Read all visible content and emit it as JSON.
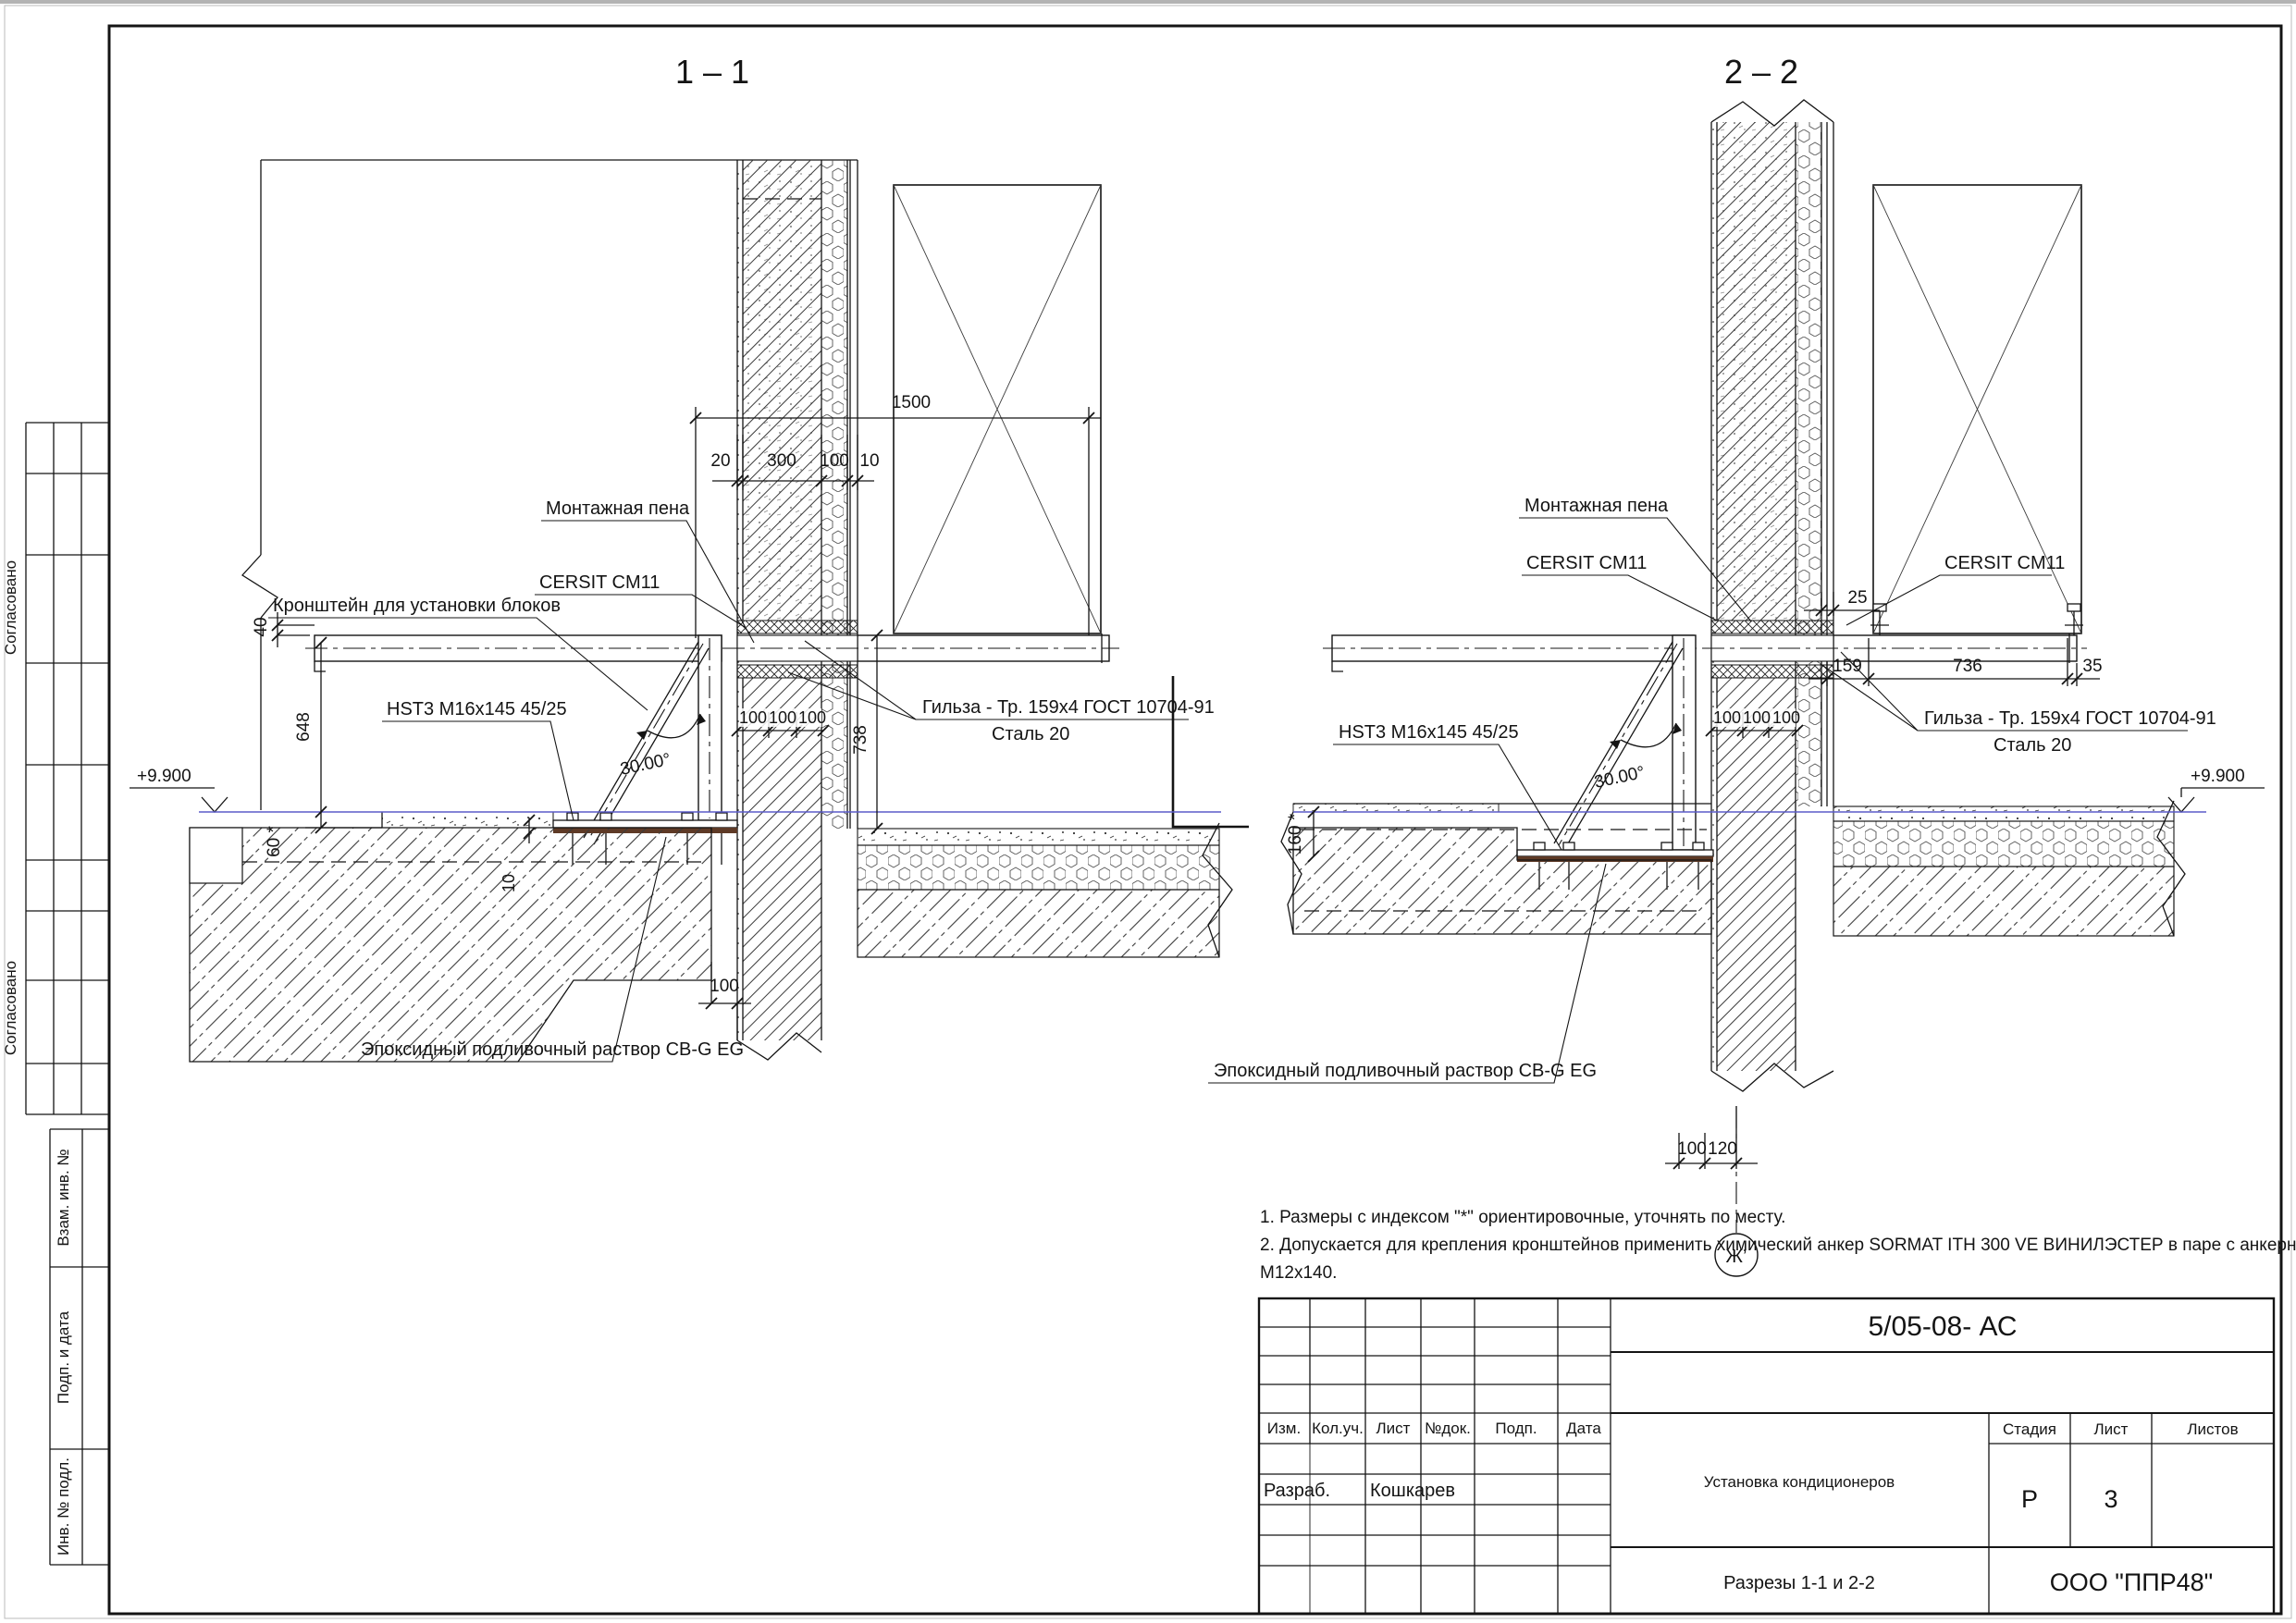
{
  "s11": {
    "title": "1 – 1",
    "montage_foam": "Монтажная пена",
    "cersit": "CERSIT CM11",
    "bracket": "Кронштейн для установки блоков",
    "hst": "HST3 M16x145 45/25",
    "gilza1": "Гильза - Тр. 159x4 ГОСТ 10704-91",
    "gilza2": "Сталь 20",
    "epoxy": "Эпоксидный подливочный раствор CB-G EG",
    "angle": "30.00°",
    "level": "+9.900",
    "d1500": "1500",
    "d20": "20",
    "d300": "300",
    "d100wall": "100",
    "d10": "10",
    "d40": "40",
    "d648": "648",
    "d60": "60 *",
    "d100_1": "100",
    "d100_2": "100",
    "d100_3": "100",
    "d738": "738",
    "d100gap": "100",
    "d10plate": "10"
  },
  "s22": {
    "title": "2 – 2",
    "montage_foam": "Монтажная пена",
    "cersit_left": "CERSIT CM11",
    "cersit_right": "CERSIT CM11",
    "hst": "HST3 M16x145 45/25",
    "gilza1": "Гильза - Тр. 159x4 ГОСТ 10704-91",
    "gilza2": "Сталь 20",
    "epoxy": "Эпоксидный подливочный раствор CB-G EG",
    "angle": "30.00°",
    "level": "+9.900",
    "d25": "25",
    "d159": "159",
    "d736": "736",
    "d35": "35",
    "d100_1": "100",
    "d100_2": "100",
    "d100_3": "100",
    "d160": "160 *",
    "d100b": "100",
    "d120": "120",
    "axis": "Ж’"
  },
  "notes": [
    "1. Размеры с индексом \"*\" ориентировочные, уточнять по месту.",
    "2. Допускается для крепления кронштейнов применить химический анкер SORMAT ITH 300 VE ВИНИЛЭСТЕР в паре с анкерной шпилькой Hilti Hit Z",
    "М12х140."
  ],
  "sidebar": {
    "soglasovano1": "Согласовано",
    "soglasovano2": "Согласовано",
    "vzam": "Взам. инв. №",
    "podp": "Подп. и дата",
    "inv": "Инв. № подл."
  },
  "titleblock": {
    "doc_number": "5/05-08- АС",
    "h_izm": "Изм.",
    "h_koluch": "Кол.уч.",
    "h_list": "Лист",
    "h_ndok": "№док.",
    "h_podp": "Подп.",
    "h_data": "Дата",
    "razrab_label": "Разраб.",
    "razrab_name": "Кошкарев",
    "project": "Установка кондиционеров",
    "stage_label": "Стадия",
    "sheet_label": "Лист",
    "sheets_label": "Листов",
    "stage": "Р",
    "sheet": "3",
    "drawing_title": "Разрезы 1-1 и 2-2",
    "company": "ООО \"ППР48\""
  }
}
